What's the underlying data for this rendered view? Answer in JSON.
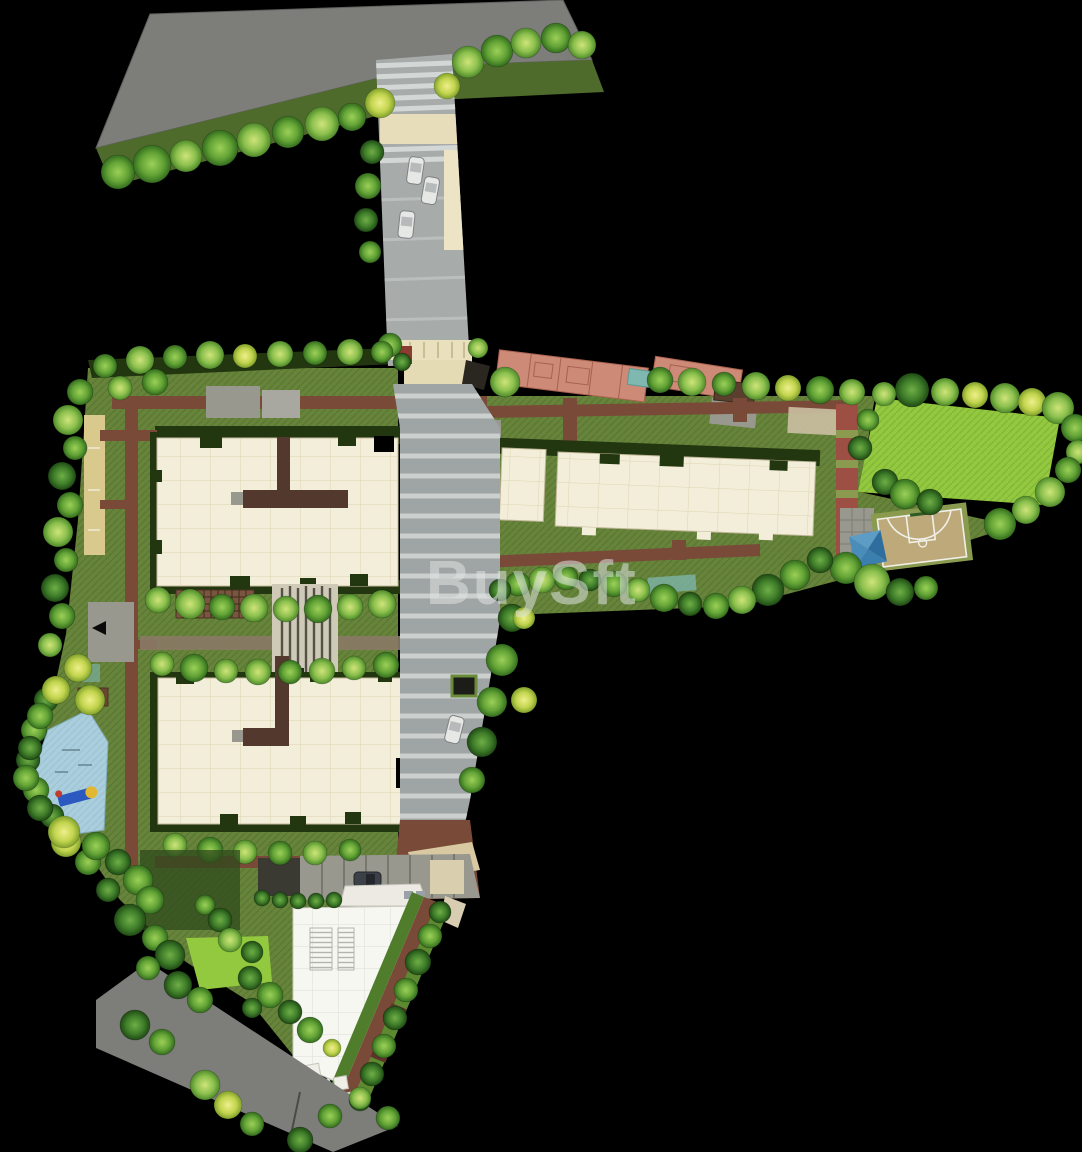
{
  "watermark": {
    "text": "BuySft"
  },
  "vehicles": {
    "driveway_cars": 3,
    "internal_road_cars": 1,
    "parked_cars": 1
  },
  "palette": {
    "background": "#000000",
    "main_road": "#7d7d7a",
    "driveway": "#a7acab",
    "internal_road": "#9fa5a4",
    "road_stripe": "#d3d7d6",
    "lawn": "#66843a",
    "lawn_dark": "#4f6b2c",
    "lawn_bright": "#93c93f",
    "hedge_dark": "#22360f",
    "tree_light": "#a6d055",
    "tree_mid": "#6faf3c",
    "tree_dark": "#3f7d2a",
    "tree_yellow": "#c9d84e",
    "building_cream": "#f3eed9",
    "building_line": "#d9d0b2",
    "corridor_brown": "#53382e",
    "path_brown": "#7a4a38",
    "paver_red": "#9c4f42",
    "paver_gray": "#98988e",
    "sand": "#d9c98c",
    "court_tan": "#bda97a",
    "court_green": "#8a9b50",
    "water_teal": "#7fb8b0",
    "playground_blue": "#a9cedd",
    "gazebo_blue": "#3a7fae",
    "clubhouse_white": "#f7f7f1",
    "stone_white": "#efefe7",
    "car_white": "#e6e8e6",
    "car_dark": "#3c4148",
    "salmon": "#cc8a77",
    "watermark_gray": "#dfe3e3"
  }
}
